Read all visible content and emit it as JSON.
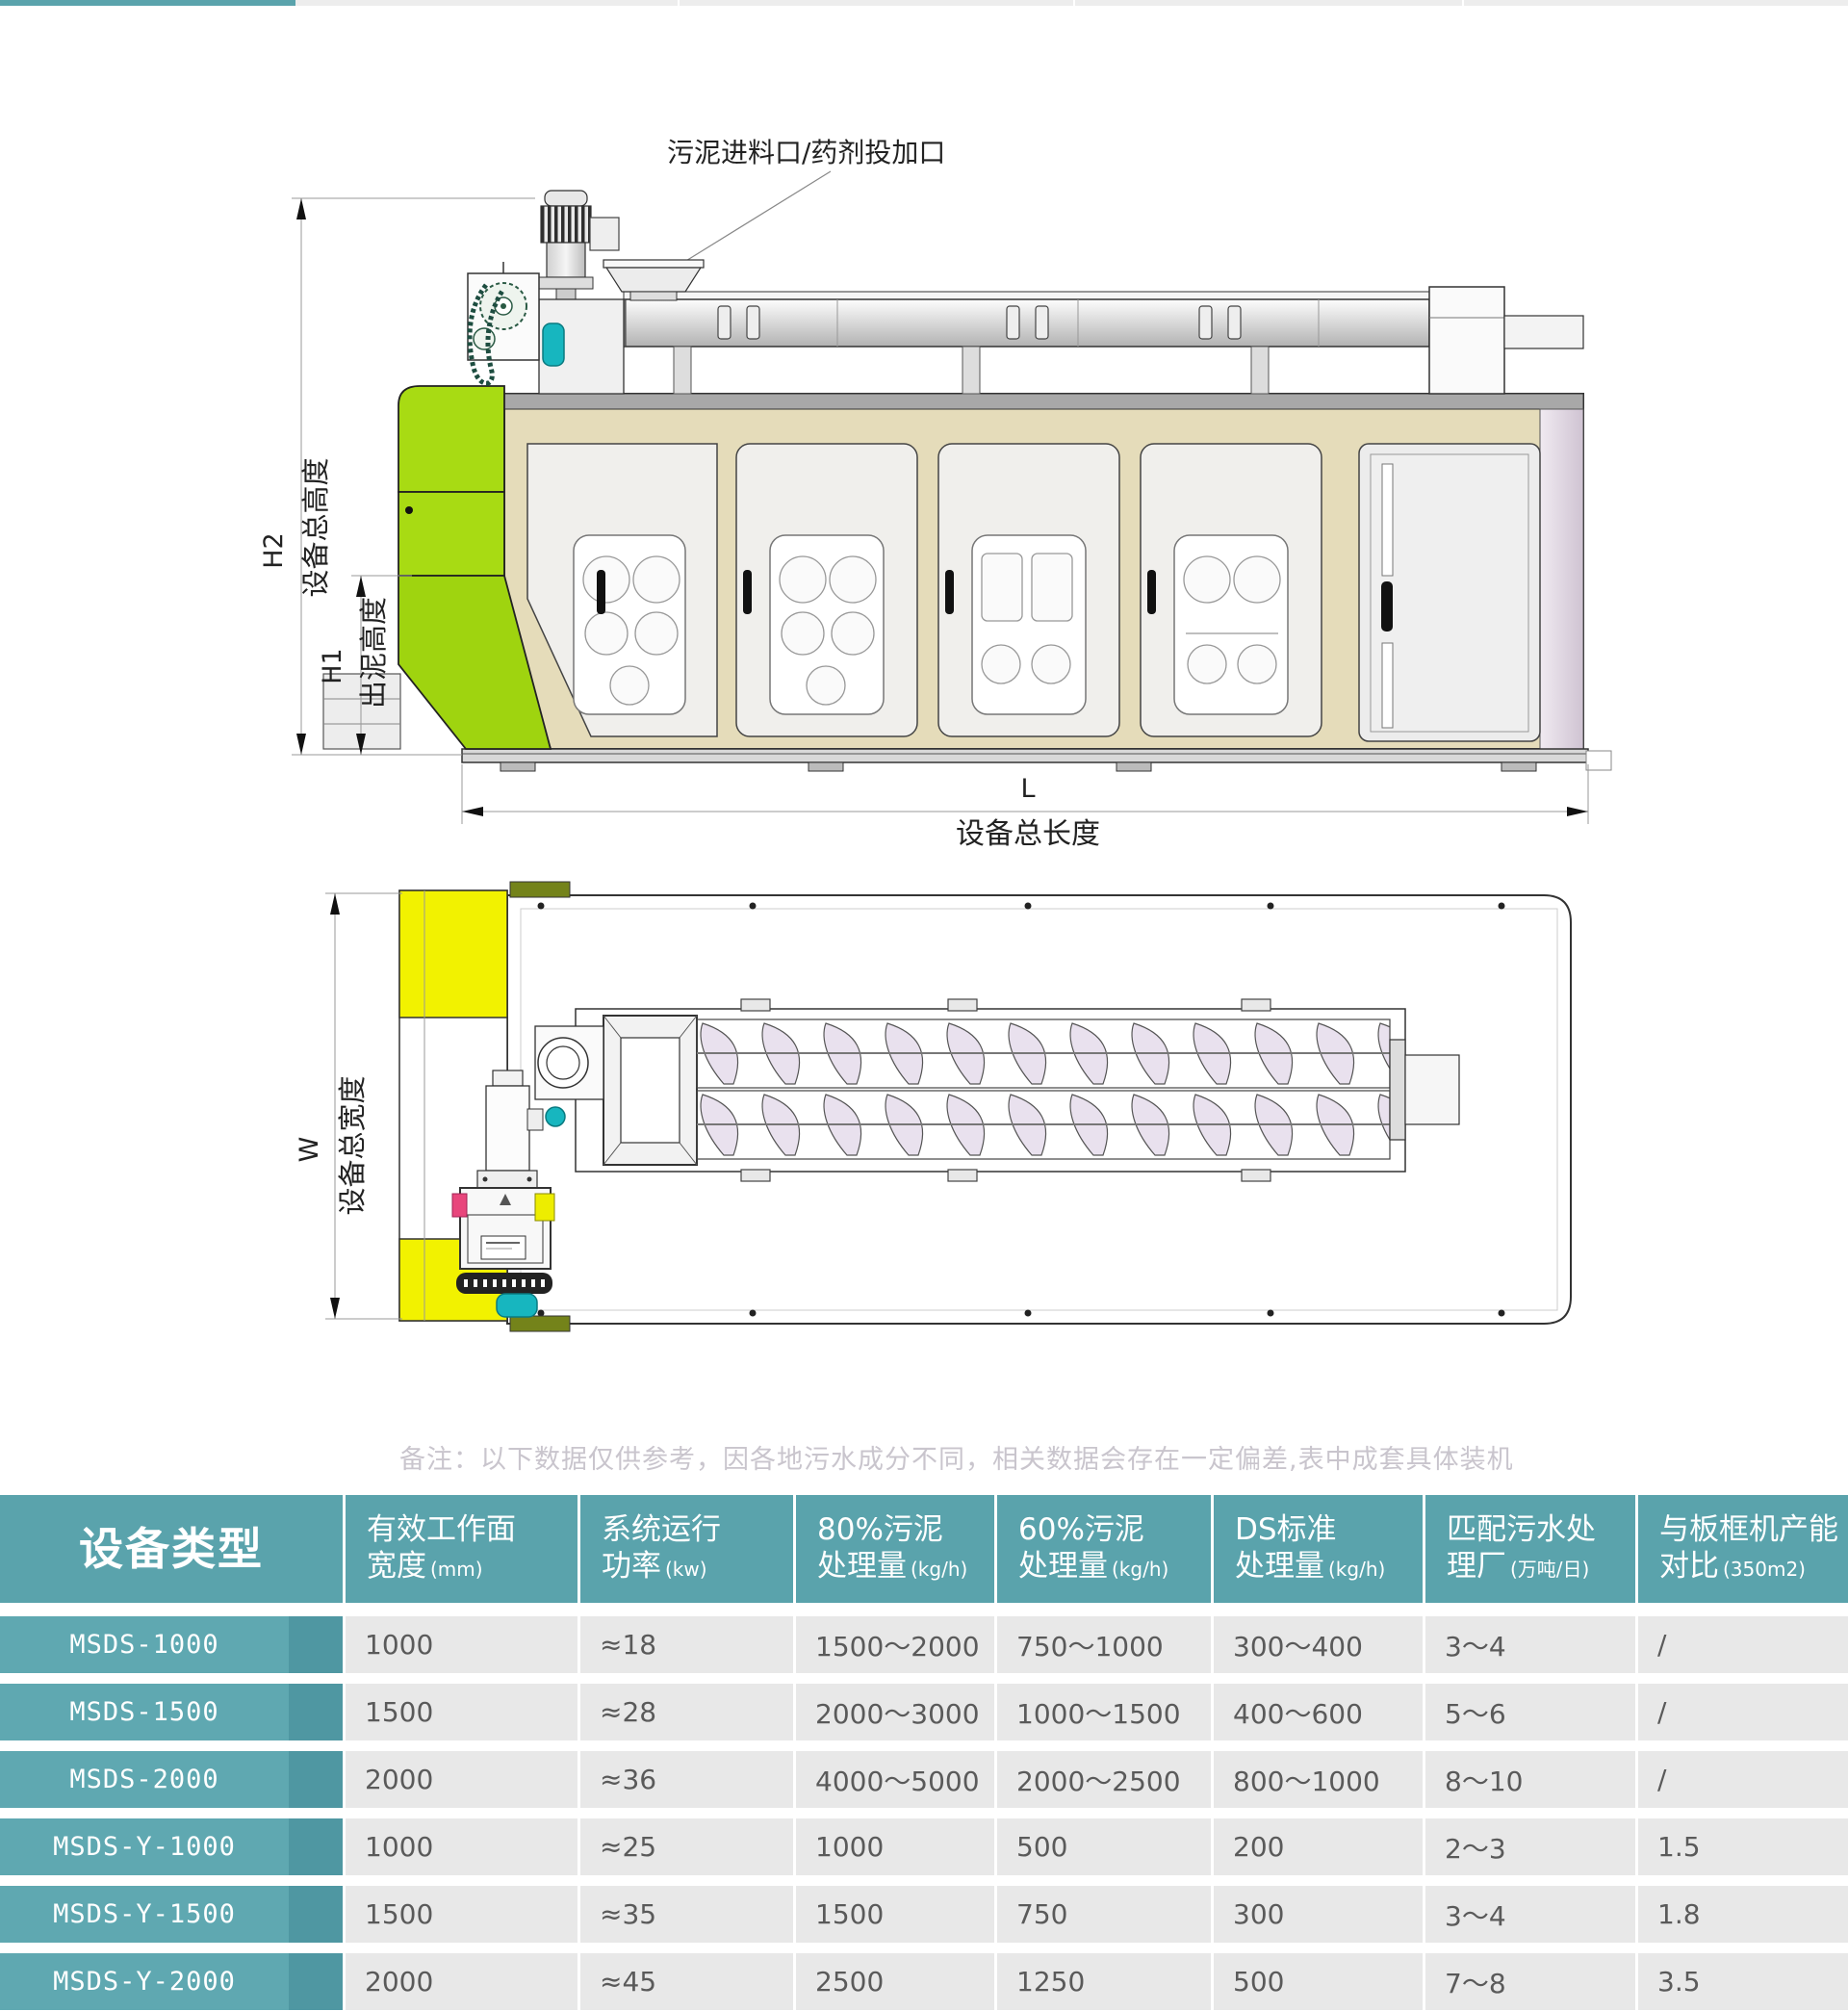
{
  "colors": {
    "header_teal": "#5AA3AC",
    "row_teal": "#5FA8B1",
    "row_teal_dark": "#4F97A2",
    "cell_gray": "#E8E8E8",
    "machine_green": "#A8DB13",
    "machine_yellow": "#F2F200",
    "machine_beige": "#E5DCBA",
    "teal_accent": "#17B6BF",
    "note_gray": "#C9C5CD"
  },
  "drawing": {
    "side_view": {
      "feed_label": "污泥进料口/药剂投加口",
      "dim_h2_code": "H2",
      "dim_h2_label": "设备总高度",
      "dim_h1_code": "H1",
      "dim_h1_label": "出泥高度",
      "dim_l_code": "L",
      "dim_l_label": "设备总长度"
    },
    "top_view": {
      "dim_w_code": "W",
      "dim_w_label": "设备总宽度"
    }
  },
  "note": "备注：以下数据仅供参考，因各地污水成分不同，相关数据会存在一定偏差,表中成套具体装机",
  "table": {
    "header": [
      {
        "title": "设备类型"
      },
      {
        "line1": "有效工作面",
        "line2": "宽度",
        "unit": "(mm)"
      },
      {
        "line1": "系统运行",
        "line2": "功率",
        "unit": "(kw)"
      },
      {
        "line1": "80%污泥",
        "line2": "处理量",
        "unit": "(kg/h)"
      },
      {
        "line1": "60%污泥",
        "line2": "处理量",
        "unit": "(kg/h)"
      },
      {
        "line1": "DS标准",
        "line2": "处理量",
        "unit": "(kg/h)"
      },
      {
        "line1": "匹配污水处",
        "line2": "理厂",
        "unit": "(万吨/日)"
      },
      {
        "line1": "与板框机产能",
        "line2": "对比",
        "unit": "(350m2)"
      }
    ],
    "rows": [
      {
        "model": "MSDS-1000",
        "values": [
          "1000",
          "≈18",
          "1500～2000",
          "750～1000",
          "300～400",
          "3～4",
          "/"
        ]
      },
      {
        "model": "MSDS-1500",
        "values": [
          "1500",
          "≈28",
          "2000～3000",
          "1000～1500",
          "400～600",
          "5～6",
          "/"
        ]
      },
      {
        "model": "MSDS-2000",
        "values": [
          "2000",
          "≈36",
          "4000～5000",
          "2000～2500",
          "800～1000",
          "8～10",
          "/"
        ]
      },
      {
        "model": "MSDS-Y-1000",
        "values": [
          "1000",
          "≈25",
          "1000",
          "500",
          "200",
          "2～3",
          "1.5"
        ]
      },
      {
        "model": "MSDS-Y-1500",
        "values": [
          "1500",
          "≈35",
          "1500",
          "750",
          "300",
          "3～4",
          "1.8"
        ]
      },
      {
        "model": "MSDS-Y-2000",
        "values": [
          "2000",
          "≈45",
          "2500",
          "1250",
          "500",
          "7～8",
          "3.5"
        ]
      }
    ]
  }
}
